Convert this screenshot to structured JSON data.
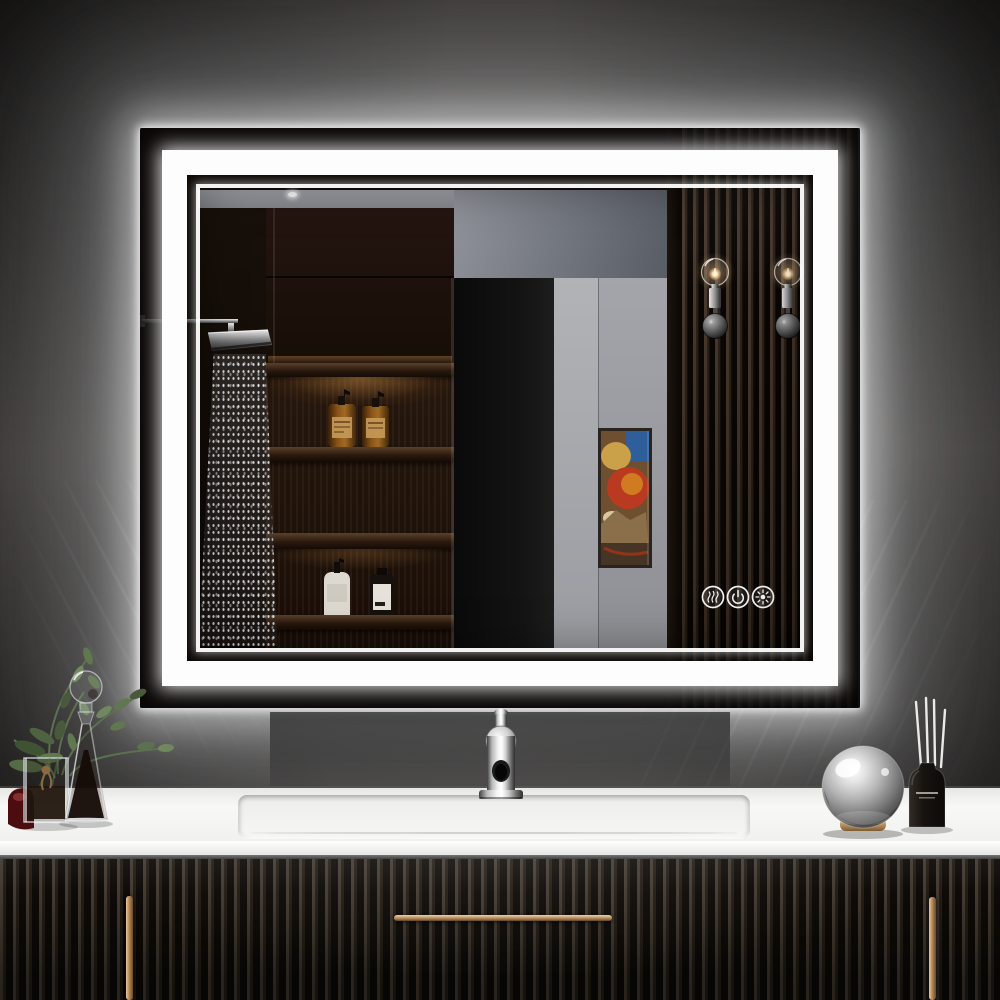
{
  "image": {
    "type": "product-photo",
    "subject": "LED backlit rectangular bathroom vanity mirror with double light band",
    "setting": "dark charcoal wall, white countertop, black fluted vanity cabinets"
  },
  "mirror": {
    "style": "frameless, front-lit inner band plus backlit halo",
    "halo_color": "#ffffff",
    "led_band_color": "#fdfdfd",
    "touch_controls": [
      {
        "name": "anti-fog",
        "icon": "defog-icon"
      },
      {
        "name": "power",
        "icon": "power-icon"
      },
      {
        "name": "brightness",
        "icon": "brightness-icon"
      }
    ],
    "reflection_elements": [
      "rain shower head with falling water",
      "dark walnut cabinet",
      "four wood shelves",
      "two amber pump bottles",
      "white pump bottle",
      "dark bottle with white label",
      "gray wall with dark doorway",
      "abstract wall art in dark frame",
      "vertical wood slat panel",
      "two glass globe wall sconces"
    ]
  },
  "vanity": {
    "countertop_color": "#f2f2f0",
    "cabinet_style": "black fluted doors and drawer",
    "handle_finish": "brushed brass",
    "sink": "integrated rectangular basin",
    "faucet": "polished chrome single-hole"
  },
  "decor": {
    "left": [
      "green sprigs in square glass vase with twine bow",
      "glass decanter with dark liquid and ball stopper",
      "red glass accent"
    ],
    "right": [
      "mirrored glass sphere on brass ring base",
      "black reed diffuser with white reeds"
    ]
  },
  "palette": {
    "wall_dark": "#1b1a19",
    "wall_mid": "#4a4745",
    "glow": "#ffffff",
    "wood_dark": "#241609",
    "slat_light": "#46382c",
    "amber_bottle": "#8a5418",
    "brass": "#c9a06b",
    "art_red": "#bf3a1e",
    "art_blue": "#2f5f9b"
  }
}
